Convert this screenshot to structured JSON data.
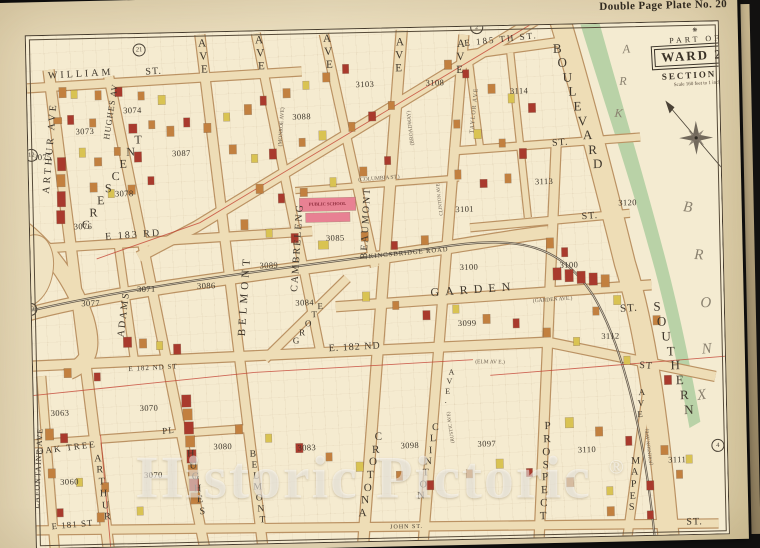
{
  "plate": {
    "title": "Double Page Plate No. 20"
  },
  "cartouche": {
    "ornament": "❋",
    "part_of": "PART OF",
    "ward": "WARD 24",
    "section": "SECTION 11",
    "scale": "Scale 160 feet to 1 inch."
  },
  "park": {
    "name": "BRONX PARK",
    "block": "3120"
  },
  "watermark": {
    "text": "Historic Pictoric",
    "symbol": "®"
  },
  "colors": {
    "paper": "#ecdfc0",
    "block_fill": "#f5ebd0",
    "road": "#eeddb6",
    "road_edge": "#bb9263",
    "o": "#c2803f",
    "r": "#a93a2d",
    "y": "#d9c352",
    "p": "#e88193",
    "park_green": "#b2cfa2",
    "boundary_red": "#c23c2e",
    "railroad": "#453c33",
    "ink": "#3c352c"
  },
  "labels": [
    {
      "n": "william-st",
      "t": "WILLIAM",
      "x": 84,
      "y": 67,
      "r": -2,
      "s": 10,
      "sp": 3
    },
    {
      "n": "william-st-suffix",
      "t": "ST.",
      "x": 157,
      "y": 66,
      "r": -2,
      "s": 10,
      "sp": 1
    },
    {
      "n": "e-185th-st",
      "t": "E 185 TH ST.",
      "x": 505,
      "y": 41,
      "r": -5,
      "s": 9,
      "sp": 2
    },
    {
      "n": "st-upper-right",
      "t": "ST.",
      "x": 562,
      "y": 146,
      "r": -3,
      "s": 10,
      "sp": 1
    },
    {
      "n": "st-mid-right",
      "t": "ST.",
      "x": 590,
      "y": 220,
      "r": -3,
      "s": 10,
      "sp": 1
    },
    {
      "n": "e-183rd-st",
      "t": "E 183 RD",
      "x": 133,
      "y": 229,
      "r": -3,
      "s": 10,
      "sp": 2
    },
    {
      "n": "garden-st",
      "t": "GARDEN",
      "x": 472,
      "y": 291,
      "r": -3,
      "s": 12,
      "sp": 6
    },
    {
      "n": "garden-st-suffix",
      "t": "ST.",
      "x": 627,
      "y": 313,
      "r": -3,
      "s": 11,
      "sp": 1
    },
    {
      "n": "garden-ave-former",
      "t": "(GARDEN AVE.)",
      "x": 551,
      "y": 303,
      "r": -3,
      "s": 5.5,
      "c": "tn"
    },
    {
      "n": "e-182nd-st-center",
      "t": "E. 182 ND",
      "x": 352,
      "y": 346,
      "r": -2,
      "s": 10,
      "sp": 1
    },
    {
      "n": "e-182nd-st-left",
      "t": "E 182 ND ST",
      "x": 150,
      "y": 362,
      "r": -2,
      "s": 7,
      "sp": 1
    },
    {
      "n": "e-182nd-st-right-suffix",
      "t": "ST",
      "x": 643,
      "y": 371,
      "r": 6,
      "s": 10,
      "sp": 1
    },
    {
      "n": "elm-ave-former",
      "t": "(ELM AV E.)",
      "x": 487,
      "y": 364,
      "r": 2,
      "s": 5.5,
      "c": "tn"
    },
    {
      "n": "oak-tree-pl",
      "t": "OAK TREE",
      "x": 62,
      "y": 440,
      "r": -6,
      "s": 9,
      "sp": 2
    },
    {
      "n": "oak-tree-pl-suffix",
      "t": "PL",
      "x": 164,
      "y": 425,
      "r": -4,
      "s": 9,
      "sp": 1
    },
    {
      "n": "e-181st-st",
      "t": "E 181 ST",
      "x": 66,
      "y": 517,
      "r": -4,
      "s": 9,
      "sp": 1
    },
    {
      "n": "john-st",
      "t": "JOHN ST.",
      "x": 400,
      "y": 527,
      "r": 0,
      "s": 6,
      "sp": 1
    },
    {
      "n": "st-bottom-right",
      "t": "ST.",
      "x": 688,
      "y": 528,
      "r": 0,
      "s": 10,
      "sp": 1
    },
    {
      "n": "columbia-st",
      "t": "(COLUMBIA ST.)",
      "x": 380,
      "y": 178,
      "r": -3,
      "s": 5.5,
      "c": "tn"
    },
    {
      "n": "kingsbridge-road",
      "t": "KINGSBRIDGE ROAD",
      "x": 408,
      "y": 253,
      "r": -4,
      "s": 6.5,
      "sp": 1
    },
    {
      "n": "crescent-ave",
      "t": "CRESCENT",
      "x": 113,
      "y": 176,
      "r": -57,
      "s": 12,
      "m": "s"
    },
    {
      "n": "grote-st",
      "t": "GROTE",
      "x": 306,
      "y": 321,
      "r": -54,
      "s": 9,
      "m": "s"
    },
    {
      "n": "arthur-ave-top",
      "t": "ARTHUR AVE",
      "x": 52,
      "y": 140,
      "r": -84,
      "s": 10,
      "sp": 3
    },
    {
      "n": "arthur-ave-bottom",
      "t": "ARTHUR",
      "x": 97,
      "y": 481,
      "r": 82,
      "s": 10,
      "m": "s"
    },
    {
      "n": "lafontaine-ave",
      "t": "LAFONTAINE AVE",
      "x": 33,
      "y": 460,
      "r": -86,
      "s": 8,
      "sp": 1
    },
    {
      "n": "hughes-av-top",
      "t": "HUGHES AV",
      "x": 113,
      "y": 105,
      "r": -80,
      "s": 8.5,
      "sp": 1
    },
    {
      "n": "hughes-ave-bottom",
      "t": "HUGHES",
      "x": 191,
      "y": 478,
      "r": 80,
      "s": 10,
      "m": "s"
    },
    {
      "n": "adams-pl",
      "t": "ADAMS",
      "x": 122,
      "y": 308,
      "r": -82,
      "s": 10,
      "sp": 2
    },
    {
      "n": "belmont-ave-top-suffix",
      "t": "AVE",
      "x": 207,
      "y": 52,
      "r": 86,
      "s": 11,
      "m": "s"
    },
    {
      "n": "belmont-ave-mid",
      "t": "BELMONT",
      "x": 243,
      "y": 292,
      "r": -85,
      "s": 11,
      "sp": 4
    },
    {
      "n": "belmont-ave-bottom",
      "t": "BELMONT",
      "x": 252,
      "y": 484,
      "r": 83,
      "s": 9.5,
      "m": "s"
    },
    {
      "n": "cambreleng-ave-top-suffix",
      "t": "AVE",
      "x": 264,
      "y": 50,
      "r": 86,
      "s": 11,
      "m": "s"
    },
    {
      "n": "cambreleng-ave",
      "t": "CAMBRELENG",
      "x": 297,
      "y": 245,
      "r": -85,
      "s": 10,
      "sp": 2
    },
    {
      "n": "monroe-ave-former",
      "t": "(MONROE AVE)",
      "x": 284,
      "y": 124,
      "r": -85,
      "s": 5.5,
      "c": "tn"
    },
    {
      "n": "beaumont-ave-top-suffix",
      "t": "AVE",
      "x": 332,
      "y": 50,
      "r": 86,
      "s": 11,
      "m": "s"
    },
    {
      "n": "beaumont-ave",
      "t": "BEAUMONT",
      "x": 366,
      "y": 222,
      "r": -86,
      "s": 10,
      "sp": 2
    },
    {
      "n": "crotona-ave-top-suffix",
      "t": "AVE",
      "x": 403,
      "y": 55,
      "r": 94,
      "s": 11,
      "m": "s"
    },
    {
      "n": "broadway-former",
      "t": "(BROADWAY)",
      "x": 413,
      "y": 128,
      "r": -95,
      "s": 5.5,
      "c": "tn"
    },
    {
      "n": "crotona-ave-bottom",
      "t": "CROTONA",
      "x": 365,
      "y": 474,
      "r": 103,
      "s": 11,
      "m": "s"
    },
    {
      "n": "clinton-ave-small",
      "t": "CLINTON AVE",
      "x": 441,
      "y": 200,
      "r": -95,
      "s": 5,
      "c": "tn"
    },
    {
      "n": "clinton-ave-suffix",
      "t": "AVE.",
      "x": 445,
      "y": 387,
      "r": 103,
      "s": 8,
      "m": "s"
    },
    {
      "n": "clinton-ave-bottom",
      "t": "CLINTON",
      "x": 423,
      "y": 462,
      "r": 103,
      "s": 10,
      "m": "s"
    },
    {
      "n": "rustic-ave-former",
      "t": "(RUSTIC AVE)",
      "x": 447,
      "y": 428,
      "r": -97,
      "s": 5,
      "c": "tn"
    },
    {
      "n": "taylor-ave",
      "t": "TAYLOR AVE",
      "x": 477,
      "y": 112,
      "r": -83,
      "s": 6,
      "sp": 1,
      "c": "tn"
    },
    {
      "n": "clinton-ave-top-suffix",
      "t": "AVE",
      "x": 464,
      "y": 58,
      "r": 94,
      "s": 11,
      "m": "s"
    },
    {
      "n": "prospect-ave",
      "t": "PROSPECT",
      "x": 540,
      "y": 474,
      "r": 94,
      "s": 11,
      "m": "s"
    },
    {
      "n": "mapes-ave",
      "t": "MAPES",
      "x": 628,
      "y": 489,
      "r": 96,
      "s": 10,
      "m": "s"
    },
    {
      "n": "mapes-ave-suffix",
      "t": "AVE",
      "x": 637,
      "y": 408,
      "r": 96,
      "s": 9,
      "m": "s"
    },
    {
      "n": "johnson-ave-former",
      "t": "(JOHNSON AVE)",
      "x": 645,
      "y": 452,
      "r": -96,
      "s": 5,
      "c": "tn"
    },
    {
      "n": "boulevard",
      "t": "BOULEVARD",
      "x": 580,
      "y": 110,
      "r": 72,
      "s": 13,
      "m": "s"
    },
    {
      "n": "southern-boulevard",
      "t": "SOUTHERN",
      "x": 670,
      "y": 364,
      "r": 74,
      "s": 13,
      "m": "s"
    },
    {
      "n": "public-school-label",
      "t": "PUBLIC SCHOOL",
      "x": 328,
      "y": 202,
      "r": 0,
      "s": 4.5,
      "c": "sc"
    },
    {
      "n": "park-letter",
      "t": "P",
      "x": 622,
      "y": 22,
      "r": -10,
      "s": 12,
      "c": "pk"
    },
    {
      "n": "park-letter",
      "t": "A",
      "x": 630,
      "y": 54,
      "r": -5,
      "s": 12,
      "c": "pk"
    },
    {
      "n": "park-letter",
      "t": "R",
      "x": 626,
      "y": 86,
      "r": 0,
      "s": 12,
      "c": "pk"
    },
    {
      "n": "park-letter",
      "t": "K",
      "x": 621,
      "y": 118,
      "r": 5,
      "s": 12,
      "c": "pk"
    },
    {
      "n": "bronx-letter",
      "t": "B",
      "x": 688,
      "y": 214,
      "r": 8,
      "s": 15,
      "c": "pk"
    },
    {
      "n": "bronx-letter",
      "t": "R",
      "x": 698,
      "y": 262,
      "r": 4,
      "s": 15,
      "c": "pk"
    },
    {
      "n": "bronx-letter",
      "t": "O",
      "x": 704,
      "y": 310,
      "r": 0,
      "s": 15,
      "c": "pk"
    },
    {
      "n": "bronx-letter",
      "t": "N",
      "x": 704,
      "y": 356,
      "r": -4,
      "s": 15,
      "c": "pk"
    },
    {
      "n": "bronx-letter",
      "t": "X",
      "x": 698,
      "y": 402,
      "r": -8,
      "s": 15,
      "c": "pk"
    }
  ],
  "blocks": [
    [
      "3073",
      87,
      124
    ],
    [
      "3074",
      135,
      104
    ],
    [
      "3075",
      44,
      149
    ],
    [
      "3076",
      83,
      219
    ],
    [
      "3078",
      125,
      187
    ],
    [
      "3087",
      183,
      148
    ],
    [
      "3077",
      89,
      296
    ],
    [
      "3071",
      145,
      283
    ],
    [
      "3086",
      205,
      281
    ],
    [
      "3088",
      304,
      114
    ],
    [
      "3089",
      268,
      262
    ],
    [
      "3103",
      368,
      83
    ],
    [
      "3108",
      438,
      83
    ],
    [
      "3114",
      522,
      93
    ],
    [
      "3113",
      545,
      184
    ],
    [
      "3101",
      465,
      210
    ],
    [
      "3085",
      335,
      236
    ],
    [
      "3084",
      303,
      300
    ],
    [
      "3100",
      468,
      268
    ],
    [
      "3100",
      568,
      268
    ],
    [
      "3099",
      465,
      324
    ],
    [
      "3112",
      608,
      340
    ],
    [
      "3063",
      56,
      405
    ],
    [
      "3070",
      145,
      402
    ],
    [
      "3070",
      148,
      469
    ],
    [
      "3060",
      64,
      474
    ],
    [
      "3080",
      218,
      442
    ],
    [
      "3083",
      302,
      445
    ],
    [
      "3098",
      405,
      445
    ],
    [
      "3097",
      482,
      445
    ],
    [
      "3110",
      582,
      453
    ],
    [
      "3111",
      672,
      465
    ],
    [
      "3120",
      628,
      207
    ]
  ],
  "plate_refs": [
    [
      "21",
      143,
      44
    ],
    [
      "12",
      33,
      147
    ],
    [
      "19",
      29,
      301
    ],
    [
      "2",
      481,
      29
    ],
    [
      "4",
      713,
      452
    ]
  ],
  "buildings": [
    [
      62,
      80,
      7,
      10,
      "o"
    ],
    [
      74,
      83,
      6,
      8,
      "y"
    ],
    [
      98,
      84,
      6,
      9,
      "o"
    ],
    [
      118,
      81,
      7,
      9,
      "r"
    ],
    [
      141,
      86,
      6,
      8,
      "o"
    ],
    [
      161,
      90,
      7,
      9,
      "y"
    ],
    [
      56,
      110,
      8,
      6,
      "o"
    ],
    [
      70,
      108,
      6,
      9,
      "r"
    ],
    [
      92,
      112,
      6,
      8,
      "o"
    ],
    [
      131,
      118,
      8,
      9,
      "r"
    ],
    [
      151,
      115,
      6,
      8,
      "o"
    ],
    [
      59,
      150,
      8,
      13,
      "r"
    ],
    [
      58,
      167,
      8,
      12,
      "o"
    ],
    [
      58,
      184,
      8,
      15,
      "r"
    ],
    [
      57,
      203,
      8,
      13,
      "r"
    ],
    [
      81,
      141,
      6,
      9,
      "y"
    ],
    [
      96,
      151,
      7,
      8,
      "o"
    ],
    [
      116,
      141,
      6,
      8,
      "o"
    ],
    [
      136,
      146,
      7,
      10,
      "r"
    ],
    [
      91,
      176,
      7,
      9,
      "o"
    ],
    [
      109,
      183,
      6,
      8,
      "y"
    ],
    [
      129,
      179,
      7,
      9,
      "o"
    ],
    [
      149,
      171,
      6,
      8,
      "r"
    ],
    [
      169,
      121,
      7,
      10,
      "o"
    ],
    [
      186,
      113,
      6,
      9,
      "r"
    ],
    [
      206,
      119,
      7,
      9,
      "o"
    ],
    [
      226,
      109,
      6,
      8,
      "y"
    ],
    [
      247,
      101,
      7,
      10,
      "o"
    ],
    [
      263,
      93,
      6,
      9,
      "r"
    ],
    [
      286,
      86,
      7,
      9,
      "o"
    ],
    [
      306,
      79,
      6,
      8,
      "y"
    ],
    [
      326,
      71,
      7,
      9,
      "o"
    ],
    [
      346,
      63,
      6,
      9,
      "r"
    ],
    [
      231,
      141,
      7,
      9,
      "o"
    ],
    [
      253,
      151,
      6,
      8,
      "y"
    ],
    [
      271,
      146,
      7,
      10,
      "r"
    ],
    [
      301,
      136,
      6,
      8,
      "o"
    ],
    [
      321,
      129,
      7,
      9,
      "y"
    ],
    [
      351,
      121,
      6,
      9,
      "o"
    ],
    [
      371,
      111,
      7,
      9,
      "r"
    ],
    [
      391,
      101,
      6,
      8,
      "o"
    ],
    [
      257,
      181,
      7,
      9,
      "o"
    ],
    [
      279,
      191,
      6,
      9,
      "r"
    ],
    [
      301,
      186,
      7,
      8,
      "o"
    ],
    [
      331,
      176,
      6,
      9,
      "y"
    ],
    [
      361,
      166,
      7,
      9,
      "o"
    ],
    [
      386,
      156,
      6,
      8,
      "r"
    ],
    [
      241,
      216,
      7,
      10,
      "o"
    ],
    [
      266,
      226,
      6,
      8,
      "y"
    ],
    [
      291,
      231,
      7,
      9,
      "r"
    ],
    [
      448,
      61,
      7,
      9,
      "o"
    ],
    [
      466,
      71,
      6,
      8,
      "r"
    ],
    [
      491,
      86,
      7,
      9,
      "o"
    ],
    [
      511,
      96,
      6,
      9,
      "y"
    ],
    [
      531,
      106,
      7,
      9,
      "r"
    ],
    [
      456,
      121,
      6,
      8,
      "o"
    ],
    [
      476,
      131,
      7,
      9,
      "y"
    ],
    [
      501,
      141,
      6,
      8,
      "o"
    ],
    [
      521,
      151,
      7,
      10,
      "r"
    ],
    [
      456,
      171,
      6,
      9,
      "o"
    ],
    [
      481,
      181,
      7,
      8,
      "r"
    ],
    [
      506,
      176,
      6,
      9,
      "o"
    ],
    [
      300,
      196,
      56,
      13,
      "p"
    ],
    [
      306,
      211,
      44,
      9,
      "p"
    ],
    [
      318,
      239,
      10,
      8,
      "y"
    ],
    [
      361,
      231,
      7,
      9,
      "o"
    ],
    [
      391,
      241,
      6,
      8,
      "r"
    ],
    [
      421,
      236,
      7,
      9,
      "o"
    ],
    [
      546,
      241,
      7,
      10,
      "o"
    ],
    [
      561,
      251,
      6,
      9,
      "r"
    ],
    [
      552,
      271,
      8,
      12,
      "r"
    ],
    [
      564,
      273,
      8,
      12,
      "r"
    ],
    [
      576,
      275,
      8,
      12,
      "r"
    ],
    [
      588,
      277,
      8,
      12,
      "r"
    ],
    [
      600,
      279,
      8,
      12,
      "o"
    ],
    [
      612,
      300,
      7,
      9,
      "y"
    ],
    [
      591,
      311,
      6,
      8,
      "o"
    ],
    [
      361,
      291,
      7,
      9,
      "y"
    ],
    [
      391,
      301,
      6,
      8,
      "o"
    ],
    [
      421,
      311,
      7,
      9,
      "r"
    ],
    [
      451,
      306,
      6,
      8,
      "y"
    ],
    [
      481,
      316,
      7,
      9,
      "o"
    ],
    [
      511,
      321,
      6,
      9,
      "r"
    ],
    [
      541,
      331,
      7,
      9,
      "o"
    ],
    [
      571,
      341,
      6,
      8,
      "y"
    ],
    [
      121,
      331,
      8,
      10,
      "r"
    ],
    [
      137,
      333,
      7,
      9,
      "o"
    ],
    [
      154,
      336,
      6,
      8,
      "y"
    ],
    [
      171,
      339,
      7,
      10,
      "r"
    ],
    [
      61,
      361,
      7,
      9,
      "o"
    ],
    [
      91,
      366,
      6,
      8,
      "r"
    ],
    [
      178,
      390,
      9,
      12,
      "r"
    ],
    [
      179,
      404,
      9,
      11,
      "o"
    ],
    [
      180,
      417,
      9,
      12,
      "r"
    ],
    [
      181,
      431,
      9,
      11,
      "o"
    ],
    [
      182,
      445,
      9,
      13,
      "r"
    ],
    [
      183,
      460,
      9,
      11,
      "o"
    ],
    [
      184,
      474,
      9,
      12,
      "r"
    ],
    [
      185,
      488,
      9,
      11,
      "o"
    ],
    [
      41,
      421,
      8,
      11,
      "o"
    ],
    [
      56,
      426,
      7,
      9,
      "r"
    ],
    [
      43,
      461,
      7,
      9,
      "o"
    ],
    [
      71,
      471,
      6,
      8,
      "y"
    ],
    [
      96,
      476,
      7,
      9,
      "o"
    ],
    [
      51,
      501,
      6,
      8,
      "r"
    ],
    [
      91,
      506,
      7,
      9,
      "o"
    ],
    [
      131,
      501,
      6,
      8,
      "y"
    ],
    [
      231,
      421,
      7,
      9,
      "o"
    ],
    [
      261,
      431,
      6,
      8,
      "y"
    ],
    [
      291,
      441,
      7,
      9,
      "r"
    ],
    [
      321,
      451,
      6,
      8,
      "o"
    ],
    [
      351,
      461,
      7,
      9,
      "y"
    ],
    [
      391,
      471,
      6,
      9,
      "o"
    ],
    [
      421,
      481,
      7,
      9,
      "r"
    ],
    [
      461,
      471,
      6,
      8,
      "o"
    ],
    [
      491,
      461,
      7,
      9,
      "y"
    ],
    [
      521,
      471,
      6,
      8,
      "r"
    ],
    [
      561,
      481,
      7,
      9,
      "o"
    ],
    [
      601,
      491,
      6,
      8,
      "y"
    ],
    [
      641,
      486,
      7,
      9,
      "r"
    ],
    [
      671,
      476,
      6,
      8,
      "o"
    ],
    [
      561,
      421,
      8,
      10,
      "y"
    ],
    [
      591,
      431,
      7,
      9,
      "o"
    ],
    [
      621,
      441,
      6,
      9,
      "r"
    ],
    [
      656,
      451,
      7,
      9,
      "o"
    ],
    [
      681,
      461,
      6,
      8,
      "y"
    ],
    [
      601,
      511,
      7,
      9,
      "o"
    ],
    [
      641,
      516,
      6,
      8,
      "r"
    ],
    [
      651,
      321,
      7,
      9,
      "o"
    ],
    [
      621,
      361,
      6,
      8,
      "y"
    ],
    [
      661,
      381,
      7,
      9,
      "r"
    ]
  ]
}
